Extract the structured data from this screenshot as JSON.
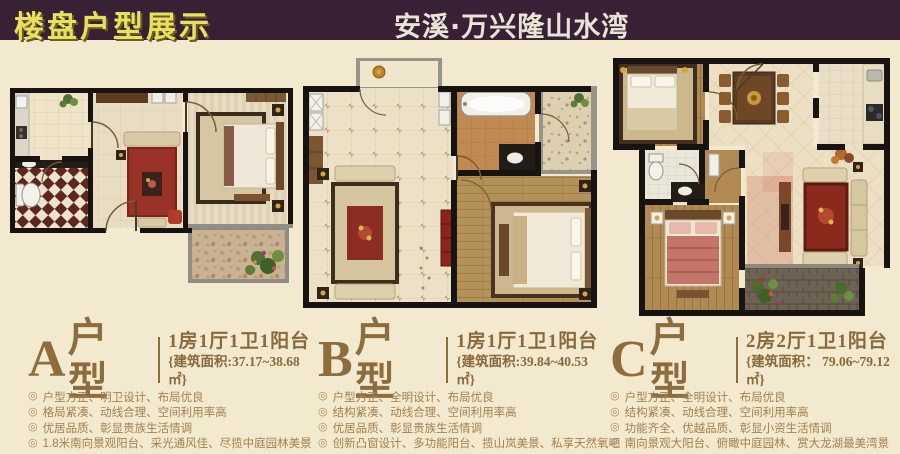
{
  "header": {
    "left_title": "楼盘户型展示",
    "center_title": "安溪·万兴隆山水湾",
    "bar_color": "#392135",
    "left_title_color": "#e9df63",
    "center_title_color": "#e9e4d6"
  },
  "colors": {
    "page_bg": "#f2e9cf",
    "text_brown": "#8d6c3e",
    "feature_brown": "#a38050",
    "plan_wall": "#171310"
  },
  "bullet_char": "◎",
  "units": [
    {
      "letter": "A",
      "suffix": "户型",
      "spec": "1房1厅1卫1阳台",
      "area": "{建筑面积:37.17~38.68㎡}",
      "features": [
        "户型方正、明卫设计、布局优良",
        "格局紧凑、动线合理、空间利用率高",
        "优居品质、彰显贵族生活情调",
        "1.8米南向景观阳台、采光通风佳、尽揽中庭园林美景"
      ]
    },
    {
      "letter": "B",
      "suffix": "户型",
      "spec": "1房1厅1卫1阳台",
      "area": "{建筑面积:39.84~40.53㎡}",
      "features": [
        "户型方正、全明设计、布局优良",
        "结构紧凑、动线合理、空间利用率高",
        "优居品质、彰显贵族生活情调",
        "创新凸窗设计、多功能阳台、揽山岚美景、私享天然氧吧"
      ]
    },
    {
      "letter": "C",
      "suffix": "户型",
      "spec": "2房2厅1卫1阳台",
      "area": "{建筑面积： 79.06~79.12㎡}",
      "features": [
        "户型方正、全明设计、布局优良",
        "结构紧凑、动线合理、空间利用率高",
        "功能齐全、优越品质、彰显小资生活情调",
        "南向景观大阳台、俯瞰中庭园林、赏大龙湖最美湾景"
      ]
    }
  ]
}
